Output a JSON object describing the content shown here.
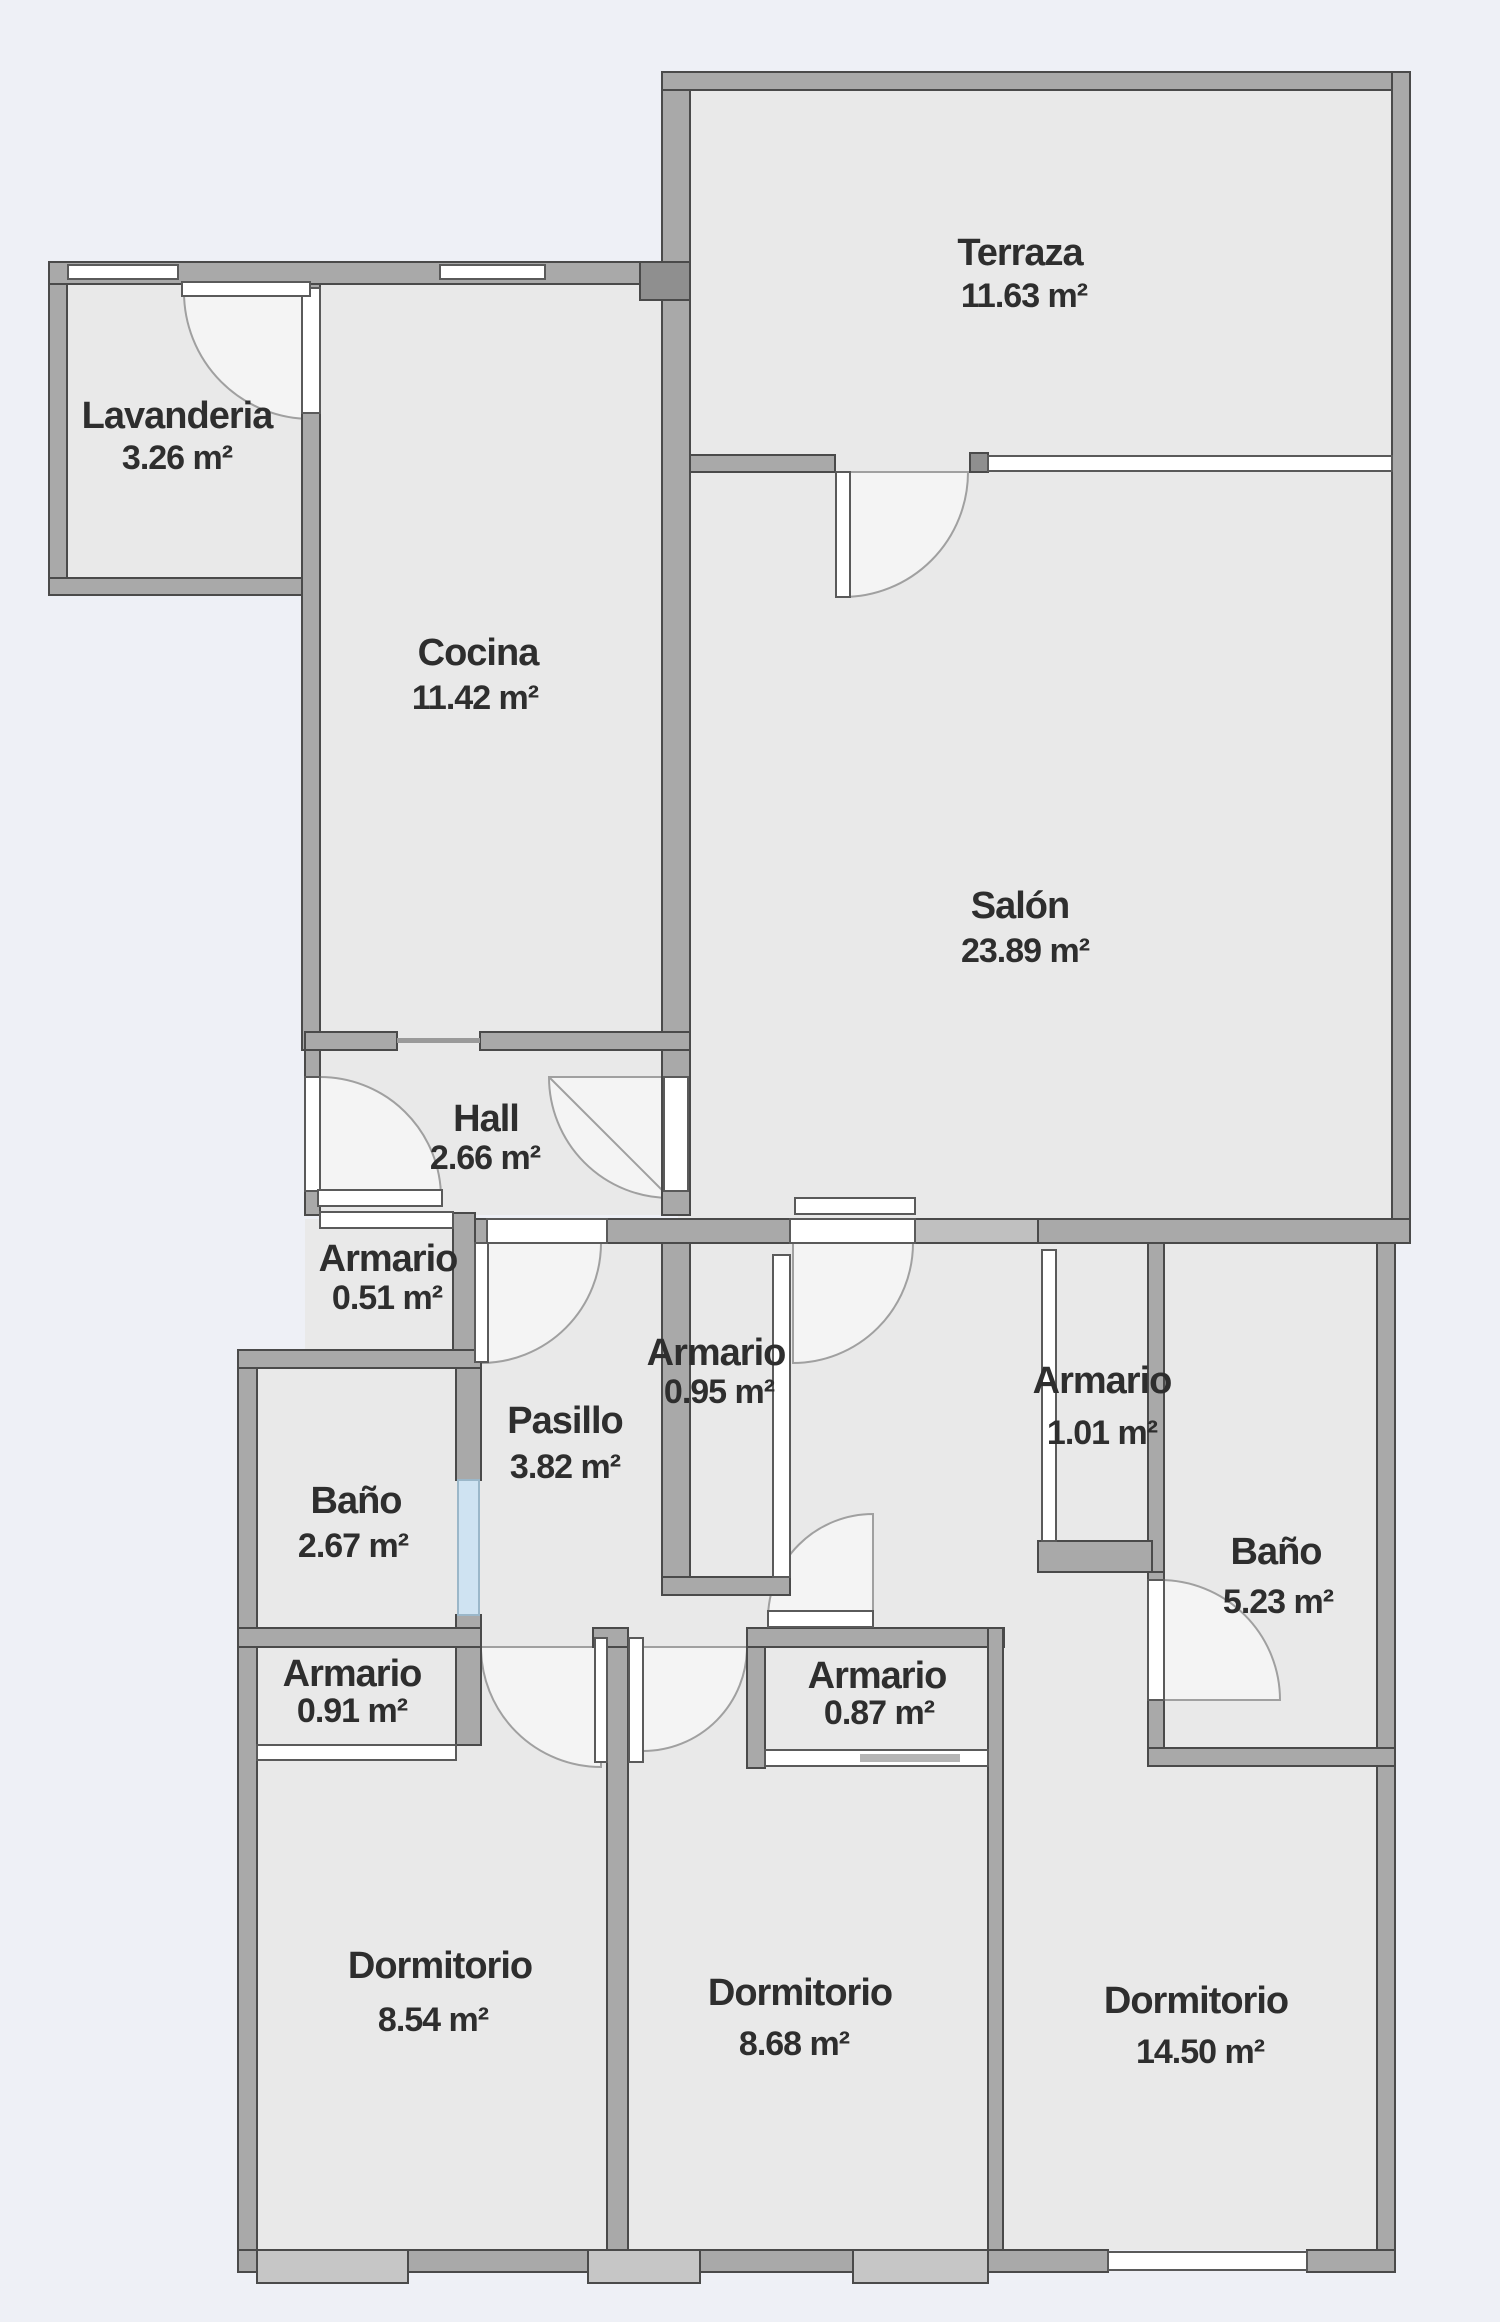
{
  "plan": {
    "title": "Floor plan",
    "colors": {
      "background": "#eef0f6",
      "room_fill": "#e9e9e9",
      "wall_fill": "#a9a9a9",
      "wall_light": "#c0c0c0",
      "wall_stroke": "#4a4a4a",
      "window_fill": "#ffffff",
      "sill_fill": "#c6c6c6",
      "glass_fill": "#cfe3f2",
      "door_arc": "#a0a0a0",
      "text_color": "#2e2e2e"
    },
    "rooms": [
      {
        "name": "Terraza",
        "area": "11.63 m²"
      },
      {
        "name": "Lavanderia",
        "area": "3.26 m²"
      },
      {
        "name": "Cocina",
        "area": "11.42 m²"
      },
      {
        "name": "Salón",
        "area": "23.89 m²"
      },
      {
        "name": "Hall",
        "area": "2.66 m²"
      },
      {
        "name": "Armario",
        "area": "0.51 m²"
      },
      {
        "name": "Armario",
        "area": "0.95 m²"
      },
      {
        "name": "Pasillo",
        "area": "3.82 m²"
      },
      {
        "name": "Armario",
        "area": "1.01 m²"
      },
      {
        "name": "Baño",
        "area": "2.67 m²"
      },
      {
        "name": "Baño",
        "area": "5.23 m²"
      },
      {
        "name": "Armario",
        "area": "0.91 m²"
      },
      {
        "name": "Armario",
        "area": "0.87 m²"
      },
      {
        "name": "Dormitorio",
        "area": "8.54 m²"
      },
      {
        "name": "Dormitorio",
        "area": "8.68 m²"
      },
      {
        "name": "Dormitorio",
        "area": "14.50 m²"
      }
    ]
  }
}
